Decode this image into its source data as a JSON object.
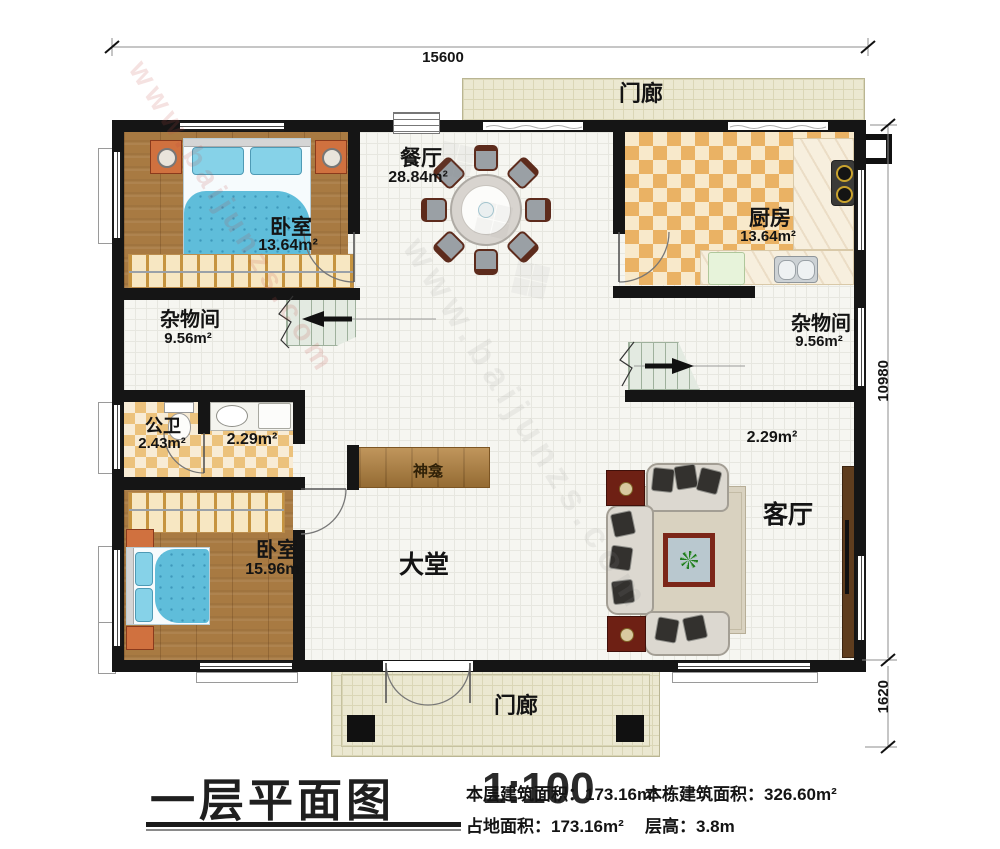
{
  "watermark": {
    "text": "www.baijunzs.com",
    "glyphs": "❖ ❖ ❖"
  },
  "dimensions": {
    "width_top": "15600",
    "height_right": "10980",
    "porch_depth_right": "1620"
  },
  "rooms": {
    "porch_top": {
      "name": "门廊"
    },
    "porch_bottom": {
      "name": "门廊"
    },
    "dining": {
      "name": "餐厅",
      "area": "28.84m²"
    },
    "kitchen": {
      "name": "厨房",
      "area": "13.64m²"
    },
    "bedroom_top": {
      "name": "卧室",
      "area": "13.64m²"
    },
    "storage_left": {
      "name": "杂物间",
      "area": "9.56m²"
    },
    "storage_right": {
      "name": "杂物间",
      "area": "9.56m²"
    },
    "bathroom": {
      "name": "公卫",
      "area": "2.43m²"
    },
    "washroom": {
      "area": "2.29m²"
    },
    "corner_nook": {
      "area": "2.29m²"
    },
    "shrine": {
      "name": "神龛"
    },
    "bedroom_bottom": {
      "name": "卧室",
      "area": "15.96m²"
    },
    "hall": {
      "name": "大堂"
    },
    "living": {
      "name": "客厅"
    }
  },
  "title_block": {
    "title": "一层平面图",
    "scale": "1:100",
    "stats": [
      {
        "text": "本层建筑面积：173.16m²"
      },
      {
        "text": "本栋建筑面积：326.60m²"
      },
      {
        "text": "占地面积：173.16m²"
      },
      {
        "text": "层高：3.8m"
      }
    ]
  }
}
